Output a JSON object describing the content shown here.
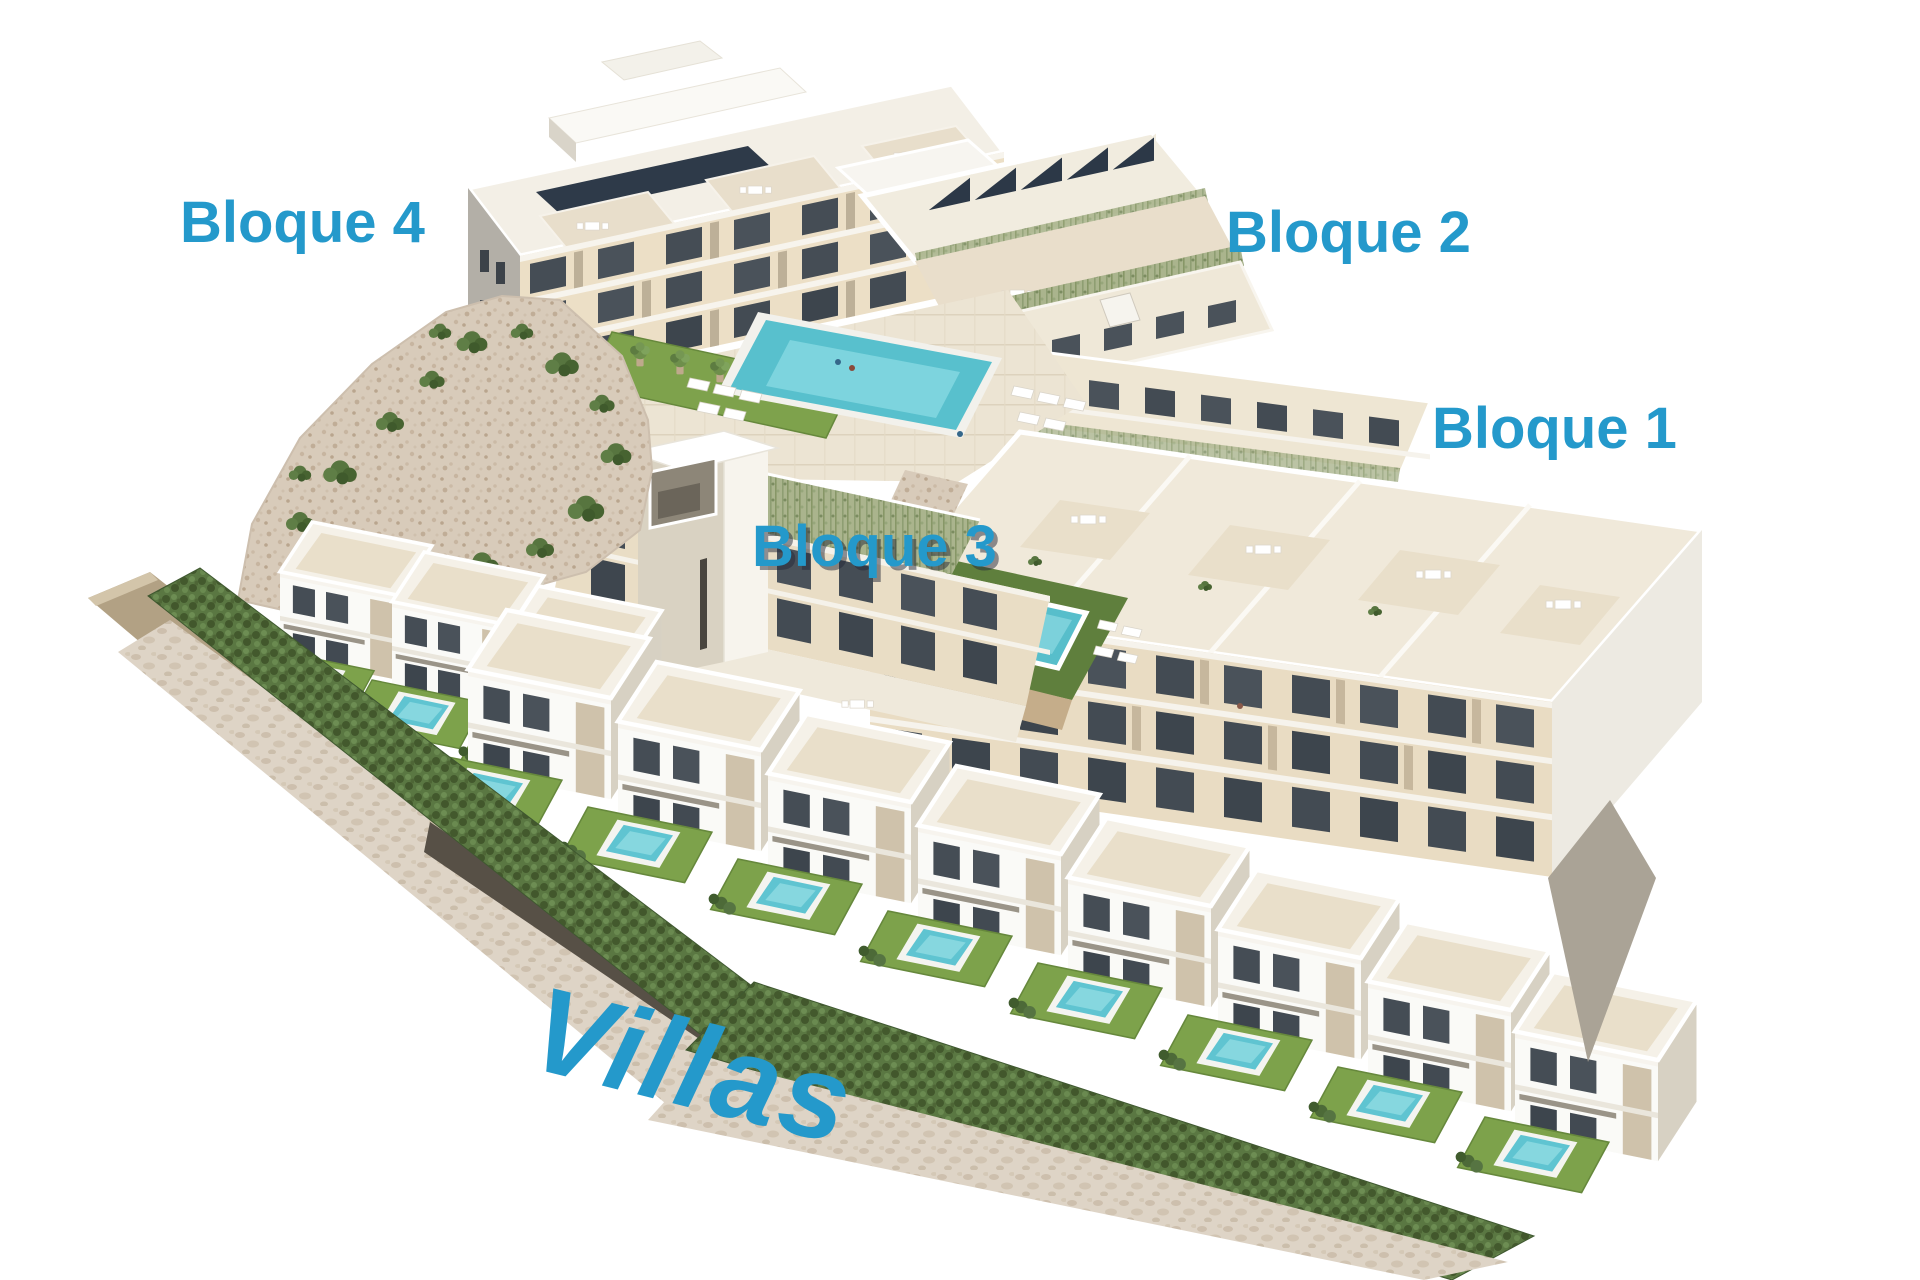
{
  "page": {
    "background": "#ffffff"
  },
  "labels": {
    "bloque4": "Bloque 4",
    "bloque2": "Bloque 2",
    "bloque1": "Bloque 1",
    "bloque3": "Bloque 3",
    "villas": "Villas"
  },
  "colors": {
    "label_blue": "#2499cb",
    "building_cream": "#ecdfc6",
    "roof_white": "#f3efe6",
    "pool_turquoise": "#58c0cd",
    "lawn_green": "#7da24b",
    "hedge_green": "#5a7742",
    "solar_panel_dark": "#2e3a49",
    "rock_gravel": "#d8cbba",
    "stone_wall": "#ded4c6"
  }
}
